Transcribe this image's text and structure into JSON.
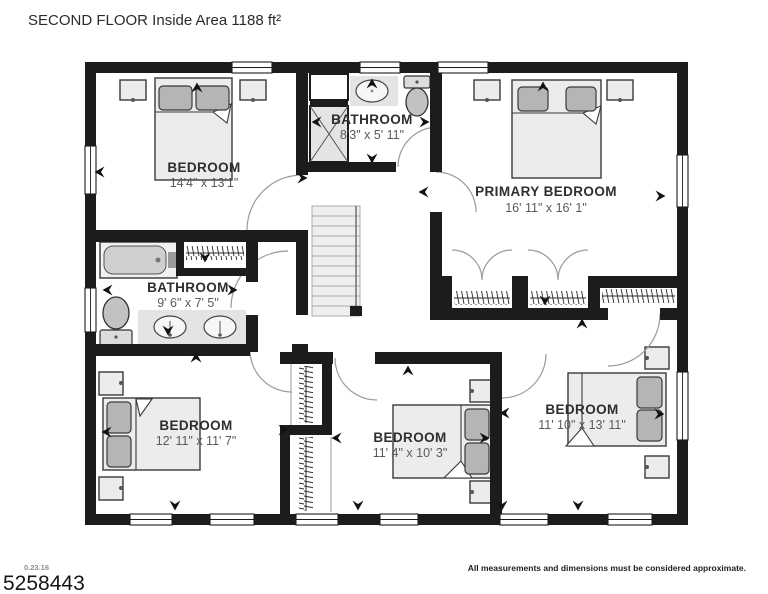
{
  "title": "SECOND FLOOR Inside Area 1188 ft²",
  "rooms": {
    "bedroom_top_left": {
      "name": "BEDROOM",
      "dims": "14'4\" x 13'1\""
    },
    "bathroom_top": {
      "name": "BATHROOM",
      "dims": "8'3\" x 5' 11\""
    },
    "primary_bedroom": {
      "name": "PRIMARY BEDROOM",
      "dims": "16' 11\" x 16' 1\""
    },
    "bathroom_mid": {
      "name": "BATHROOM",
      "dims": "9' 6\" x 7' 5\""
    },
    "bedroom_bottom_left": {
      "name": "BEDROOM",
      "dims": "12' 11\" x 11' 7\""
    },
    "bedroom_bottom_middle": {
      "name": "BEDROOM",
      "dims": "11' 4\" x 10' 3\""
    },
    "bedroom_bottom_right": {
      "name": "BEDROOM",
      "dims": "11' 10\" x 13' 11\""
    }
  },
  "footer": {
    "date_code": "0.23.16",
    "listing_id": "5258443",
    "disclaimer": "All measurements and dimensions must be considered approximate."
  },
  "colors": {
    "wall": "#1c1c1c",
    "furniture": "#ececec",
    "pillow": "#b5b5b5",
    "room_label": "#2e2e2e",
    "dims_label": "#5a5a5a"
  }
}
